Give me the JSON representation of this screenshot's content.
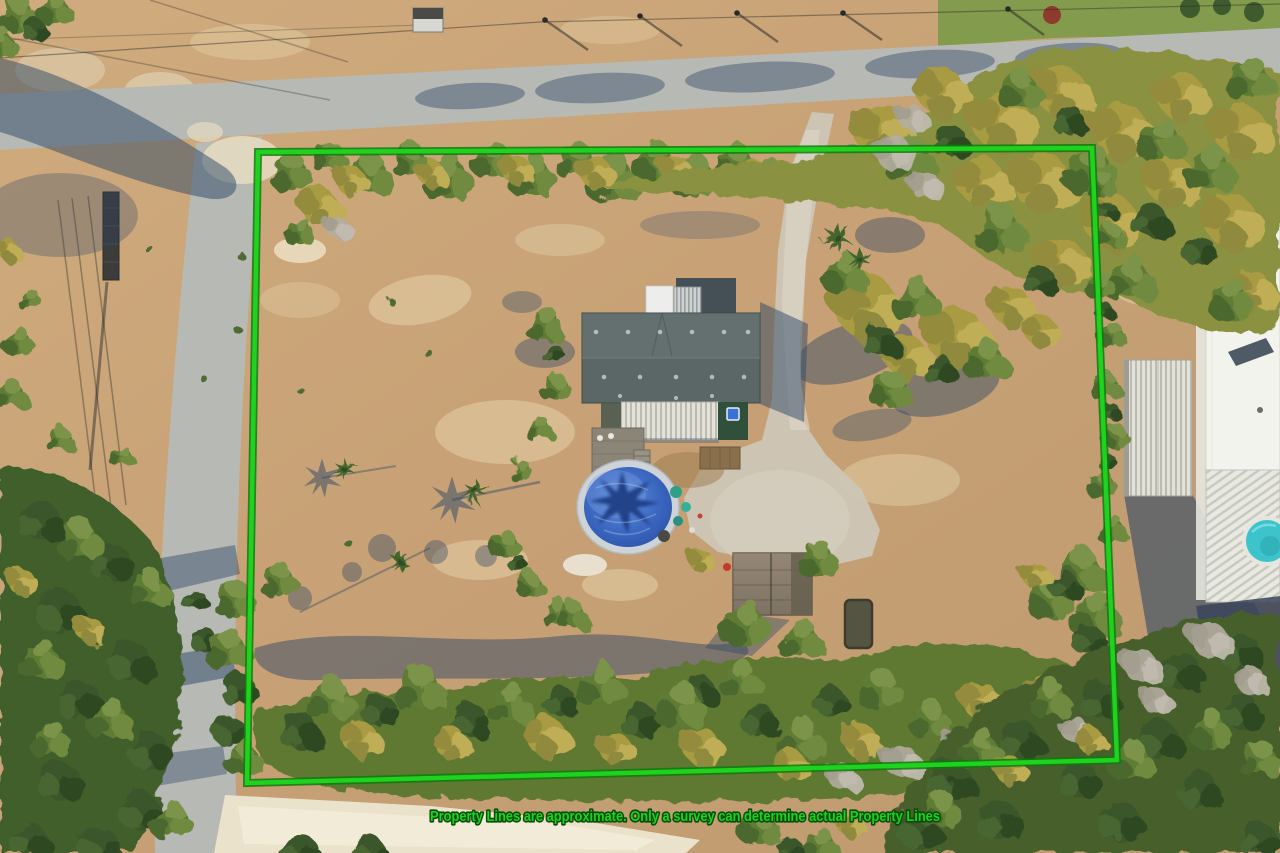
{
  "image": {
    "kind": "aerial-drone-photo",
    "subject": "Residential lot with highlighted property boundary",
    "width_px": 1280,
    "height_px": 853
  },
  "overlay": {
    "disclaimer_text": "Property Lines are approximate. Only a survey can determine actual Property Lines",
    "disclaimer_fill": "#1cd31c",
    "disclaimer_outline": "#0a4a0a",
    "boundary": {
      "points": "258,152 1092,148 1117,760 247,783",
      "color": "#1ed21e",
      "outline_color": "#0f7a0f"
    }
  },
  "scene": {
    "colors": {
      "field": "#c9a478",
      "field_light": "#e7d4ab",
      "road": "#b7b9b4",
      "sand_road": "#ebe2cb",
      "driveway": "#cdc6b6",
      "tree_green": "#5e7b36",
      "tree_olive": "#a89b42",
      "tree_dark": "#3b5629",
      "tree_bare": "#b3ada0",
      "shadow_blue": "#2e4766",
      "house_roof": "#5b6667",
      "house_annex": "#454f56",
      "awning_white": "#e3e2da",
      "porch_wall_green": "#31503c",
      "pool_frame": "#ced3d7",
      "pool_cover": "#3f6cc4",
      "pool_cover_dark": "#16347c",
      "shed_roof": "#8e8172",
      "neighbor_roof_white": "#f3f3ee",
      "neighbor_garage": "#d6d5cc",
      "neighbor_pool": "#3cc3cb"
    },
    "landmarks": [
      "paved street along top edge",
      "paved street along left edge",
      "gravel driveway from street to house",
      "main house with dark shingle roof and metal awning",
      "round above-ground pool with blue cover",
      "wood shed in back yard",
      "open sandy yard with scattered trees and palm shadows",
      "tree rows along lot edges",
      "neighboring house with white metal roof at right",
      "small round pool at lower right",
      "white sand road along bottom"
    ]
  }
}
